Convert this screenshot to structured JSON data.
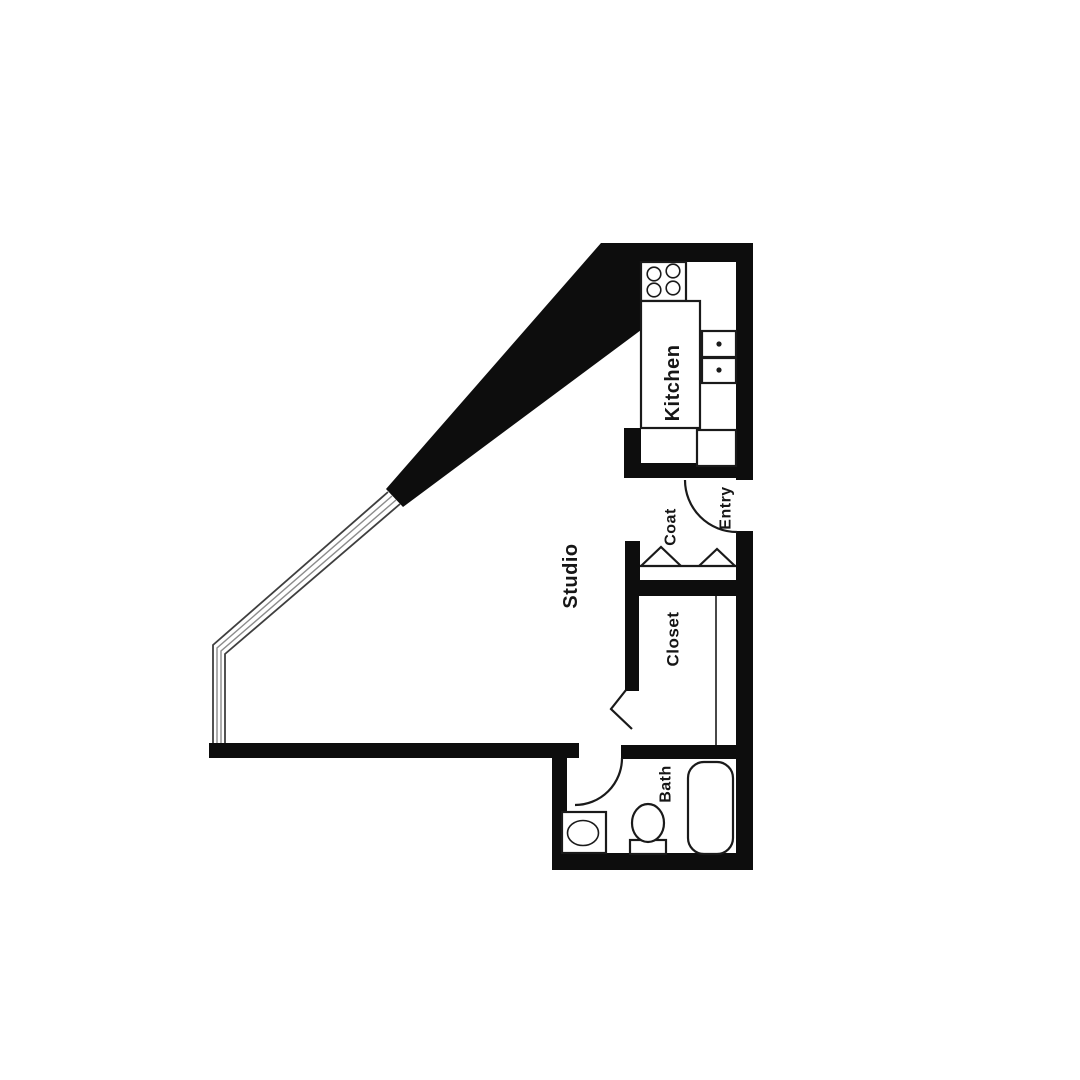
{
  "plan": {
    "type": "apartment-floor-plan",
    "rooms": {
      "studio": {
        "label": "Studio"
      },
      "kitchen": {
        "label": "Kitchen"
      },
      "entry": {
        "label": "Entry"
      },
      "coat": {
        "label": "Coat"
      },
      "closet": {
        "label": "Closet"
      },
      "bath": {
        "label": "Bath"
      }
    },
    "colors": {
      "wall": "#0d0d0d",
      "fixture_line": "#1a1a1a",
      "window_line": "#3f3f3f",
      "label_text": "#161616",
      "background": "#ffffff"
    },
    "fixture_icons": [
      "stove-burners-icon",
      "kitchen-counter-icon",
      "refrigerator-icon",
      "double-sink-icon",
      "entry-door-swing-icon",
      "bifold-doors-icon",
      "closet-door-icon",
      "closet-rod-icon",
      "bath-door-swing-icon",
      "bathroom-sink-icon",
      "toilet-icon",
      "bathtub-icon",
      "window-wall-icon"
    ]
  }
}
